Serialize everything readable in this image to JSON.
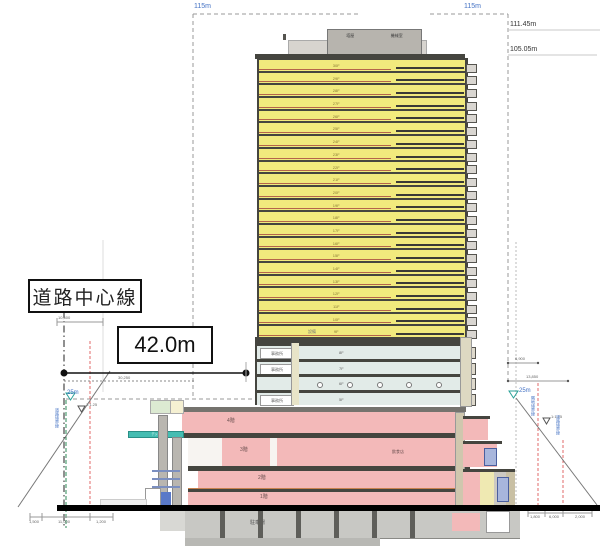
{
  "annotations": {
    "road_center_label": "道路中心線",
    "distance_label": "42.0m",
    "height_limit_left": "115m",
    "height_limit_right": "115m",
    "height_top": "111.45m",
    "height_roof": "105.05m",
    "level_25m_left": "25m",
    "level_25m_right": "25m",
    "slope_left": "1:1.25",
    "slope_right": "1:1.25",
    "dim_upper_left": "10,600",
    "dim_dashed_left": "30,250",
    "dim_right_1": "6,900",
    "dim_right_2": "13,850",
    "bottom_dims_left": [
      "1,500",
      "11,000",
      "1,200"
    ],
    "bottom_dims_right": [
      "1,800",
      "6,000",
      "2,000"
    ],
    "boundary_left": "道路境界線",
    "boundary_right_1": "隣地境界線",
    "boundary_right_2": "道路境界線"
  },
  "building": {
    "penthouse_labels": [
      "塔屋",
      "機械室"
    ],
    "roof_note": "設備",
    "tower_floors": [
      "30F",
      "29F",
      "28F",
      "27F",
      "26F",
      "25F",
      "24F",
      "23F",
      "22F",
      "21F",
      "20F",
      "19F",
      "18F",
      "17F",
      "16F",
      "15F",
      "14F",
      "13F",
      "12F",
      "11F",
      "10F",
      "9F"
    ],
    "mid_floors": [
      {
        "label": "8F",
        "left": "事務所"
      },
      {
        "label": "7F",
        "left": "事務所"
      },
      {
        "label": "6F",
        "circles": true
      },
      {
        "label": "5F",
        "left": "事務所"
      }
    ],
    "podium": {
      "floors": [
        {
          "label": "4階"
        },
        {
          "label": "3階"
        },
        {
          "label": "2階"
        },
        {
          "label": "1階"
        }
      ],
      "room_right": "飲食店",
      "deck_label": "デッキ",
      "basement_label": "駐車場"
    }
  },
  "colors": {
    "floor_yellow": "#f1ea7d",
    "floor_blue": "#e2ebe8",
    "podium_pink": "#f3b9b9",
    "slab_dark": "#45453f",
    "teal_accent": "#45bdb2",
    "dim_blue": "#4472c4",
    "red_dash": "#e06a6a",
    "green_dash": "#2e8b57"
  }
}
